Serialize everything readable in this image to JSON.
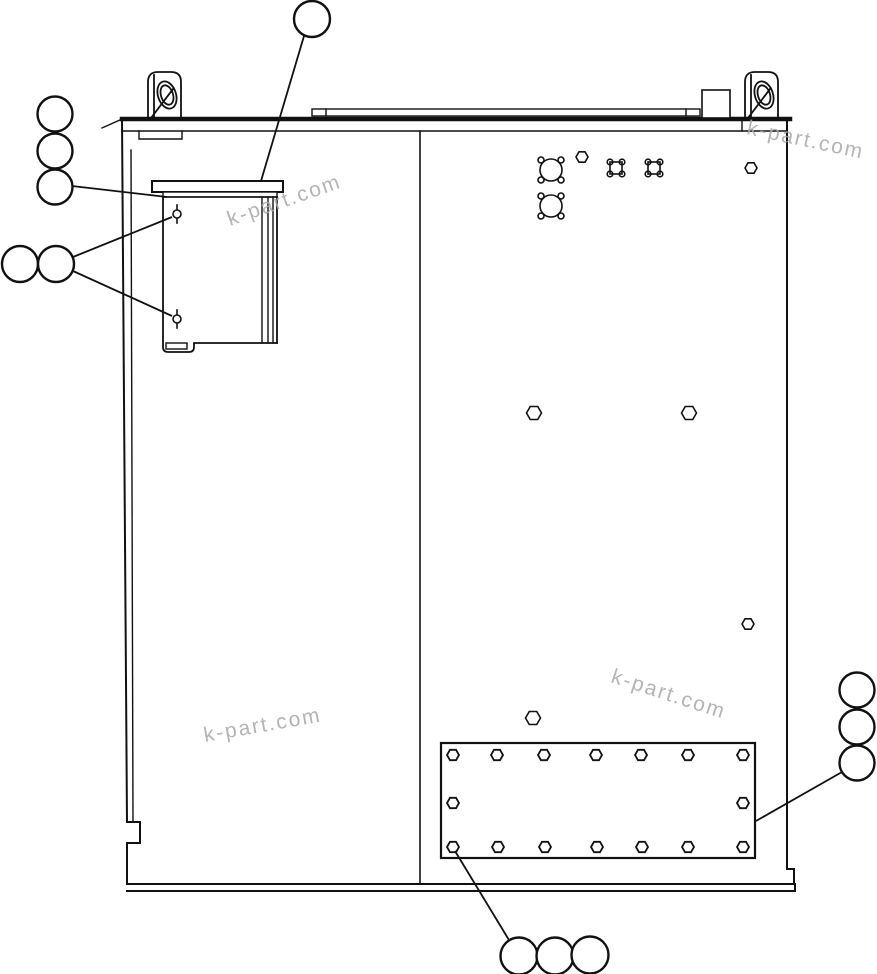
{
  "artwork": {
    "description": "black-and-white technical parts line drawing of a cabinet side panel",
    "ink_color": "#111111",
    "background_color": "#ffffff"
  },
  "watermark": {
    "text": "k-part.com",
    "color": "#a8a8a8",
    "instances": 4
  },
  "callouts": {
    "style": "empty circular balloons with leader lines",
    "groups": [
      {
        "id": "top-single",
        "circles": 1
      },
      {
        "id": "upper-left-stack",
        "circles": 3
      },
      {
        "id": "left-pair",
        "circles": 2
      },
      {
        "id": "right-stack",
        "circles": 3
      },
      {
        "id": "bottom-row",
        "circles": 3
      }
    ]
  },
  "fasteners": {
    "panel_hex_bolts": 6,
    "cover_plate_hex_bolts": 16,
    "round_mount_patterns": 2,
    "square_mount_patterns": 2,
    "bracket_screws": 2,
    "lifting_lugs": 2
  }
}
